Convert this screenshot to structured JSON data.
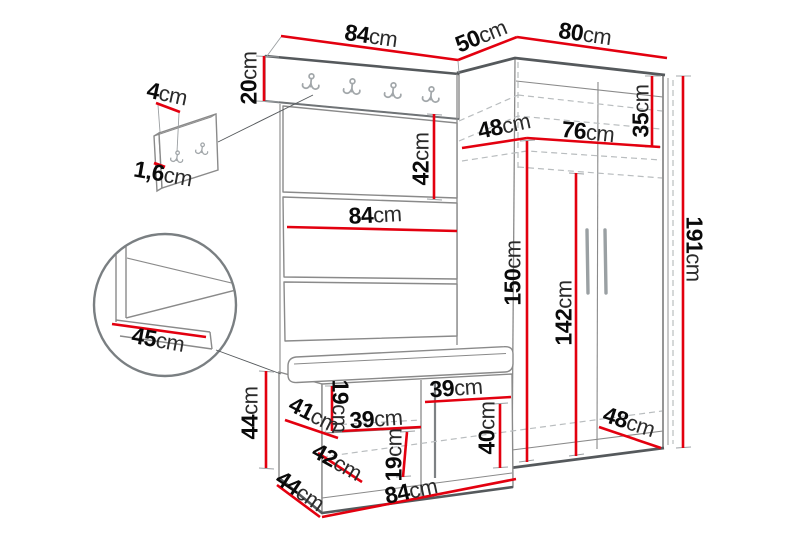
{
  "diagram": {
    "kind": "furniture dimension drawing",
    "unit": "cm",
    "colors": {
      "dimension_line": "#e3000f",
      "outline": "#8a8a8a",
      "outline_dark": "#55595c",
      "hidden_line": "#b9bdbf",
      "background": "#ffffff"
    }
  },
  "measurements": [
    {
      "id": "wall-panel-width",
      "value": "4",
      "unit": "cm",
      "x": 167,
      "y": 94,
      "rot": 12
    },
    {
      "id": "wall-panel-thickness",
      "value": "1,6",
      "unit": "cm",
      "x": 163,
      "y": 174,
      "rot": 10
    },
    {
      "id": "rack-width-top",
      "value": "84",
      "unit": "cm",
      "x": 371,
      "y": 36,
      "rot": 8
    },
    {
      "id": "hook-rail-height",
      "value": "20",
      "unit": "cm",
      "x": 249,
      "y": 78,
      "rot": -90
    },
    {
      "id": "wardrobe-top-side",
      "value": "50",
      "unit": "cm",
      "x": 481,
      "y": 36,
      "rot": -22
    },
    {
      "id": "wardrobe-top-width",
      "value": "80",
      "unit": "cm",
      "x": 585,
      "y": 34,
      "rot": 8
    },
    {
      "id": "top-shelf-depth",
      "value": "48",
      "unit": "cm",
      "x": 504,
      "y": 126,
      "rot": -12
    },
    {
      "id": "top-shelf-width",
      "value": "76",
      "unit": "cm",
      "x": 588,
      "y": 132,
      "rot": 6
    },
    {
      "id": "top-shelf-height",
      "value": "35",
      "unit": "cm",
      "x": 641,
      "y": 111,
      "rot": -90
    },
    {
      "id": "upper-panel-height",
      "value": "42",
      "unit": "cm",
      "x": 421,
      "y": 159,
      "rot": -90
    },
    {
      "id": "rack-width-mid",
      "value": "84",
      "unit": "cm",
      "x": 375,
      "y": 215,
      "rot": -3
    },
    {
      "id": "wardrobe-inner-height",
      "value": "150",
      "unit": "cm",
      "x": 513,
      "y": 273,
      "rot": -90
    },
    {
      "id": "door-height",
      "value": "142",
      "unit": "cm",
      "x": 564,
      "y": 313,
      "rot": -90
    },
    {
      "id": "total-height",
      "value": "191",
      "unit": "cm",
      "x": 694,
      "y": 249,
      "rot": 90
    },
    {
      "id": "detail-seat-depth",
      "value": "45",
      "unit": "cm",
      "x": 158,
      "y": 340,
      "rot": 10
    },
    {
      "id": "bench-height",
      "value": "44",
      "unit": "cm",
      "x": 250,
      "y": 413,
      "rot": -90
    },
    {
      "id": "bench-shelf-depth",
      "value": "41",
      "unit": "cm",
      "x": 314,
      "y": 415,
      "rot": 27
    },
    {
      "id": "bench-upper-gap",
      "value": "19",
      "unit": "cm",
      "x": 340,
      "y": 406,
      "rot": 90
    },
    {
      "id": "bench-shelf-width",
      "value": "39",
      "unit": "cm",
      "x": 376,
      "y": 419,
      "rot": -4
    },
    {
      "id": "bench-lower-depth",
      "value": "42",
      "unit": "cm",
      "x": 337,
      "y": 462,
      "rot": 29
    },
    {
      "id": "bench-lower-gap",
      "value": "19",
      "unit": "cm",
      "x": 394,
      "y": 455,
      "rot": -90
    },
    {
      "id": "bench-niche-width",
      "value": "39",
      "unit": "cm",
      "x": 456,
      "y": 388,
      "rot": -4
    },
    {
      "id": "bench-niche-height",
      "value": "40",
      "unit": "cm",
      "x": 487,
      "y": 428,
      "rot": -90
    },
    {
      "id": "bench-depth",
      "value": "44",
      "unit": "cm",
      "x": 300,
      "y": 491,
      "rot": 34
    },
    {
      "id": "bench-width",
      "value": "84",
      "unit": "cm",
      "x": 411,
      "y": 491,
      "rot": -12
    },
    {
      "id": "wardrobe-depth-bottom",
      "value": "48",
      "unit": "cm",
      "x": 629,
      "y": 422,
      "rot": 18
    }
  ]
}
